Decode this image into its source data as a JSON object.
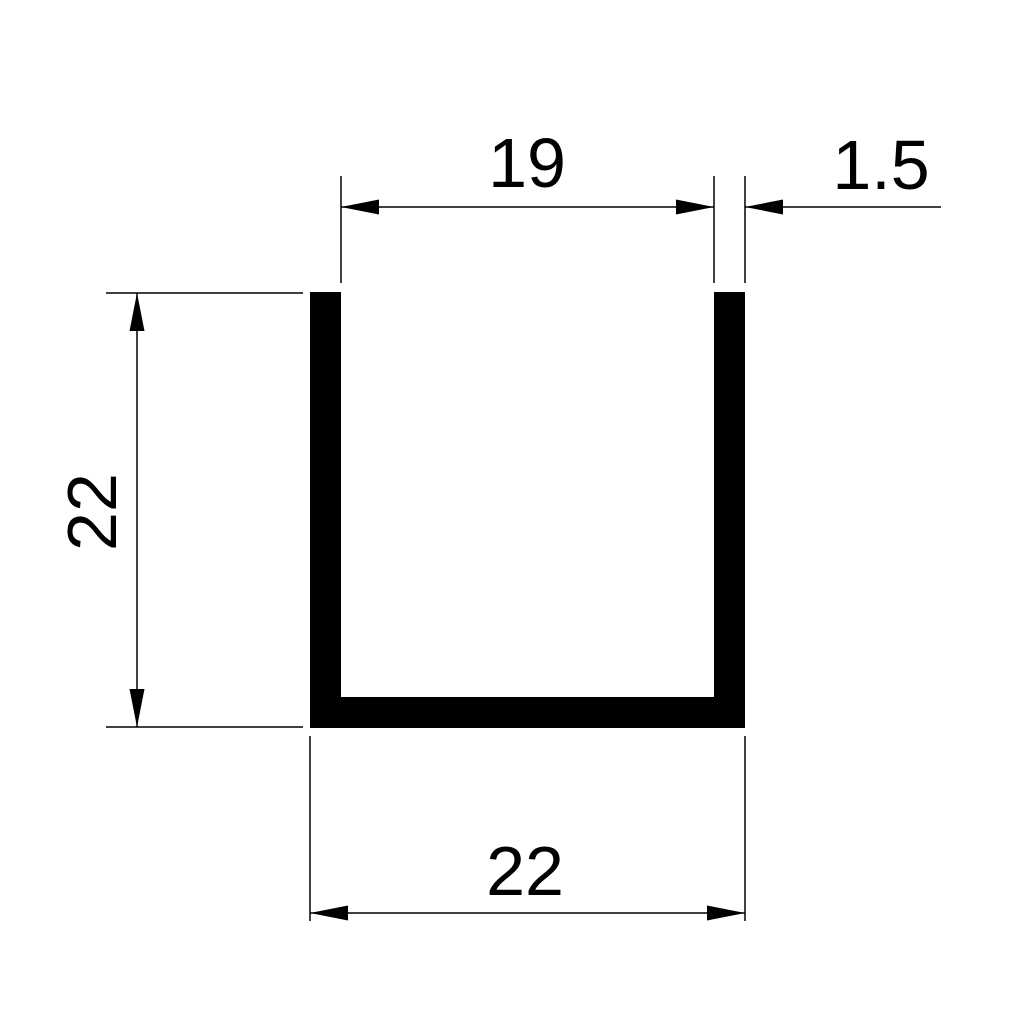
{
  "drawing": {
    "type": "technical dimension drawing",
    "subject": "U-channel profile cross-section",
    "background_color": "#ffffff",
    "line_color": "#000000",
    "profile_fill_color": "#000000"
  },
  "dimensions": {
    "inner_width": {
      "label": "19",
      "value": 19,
      "position": "top",
      "orientation": "horizontal"
    },
    "wall_thickness": {
      "label": "1.5",
      "value": 1.5,
      "position": "top-right",
      "orientation": "horizontal"
    },
    "height": {
      "label": "22",
      "value": 22,
      "position": "left",
      "orientation": "vertical"
    },
    "outer_width": {
      "label": "22",
      "value": 22,
      "position": "bottom",
      "orientation": "horizontal"
    }
  }
}
